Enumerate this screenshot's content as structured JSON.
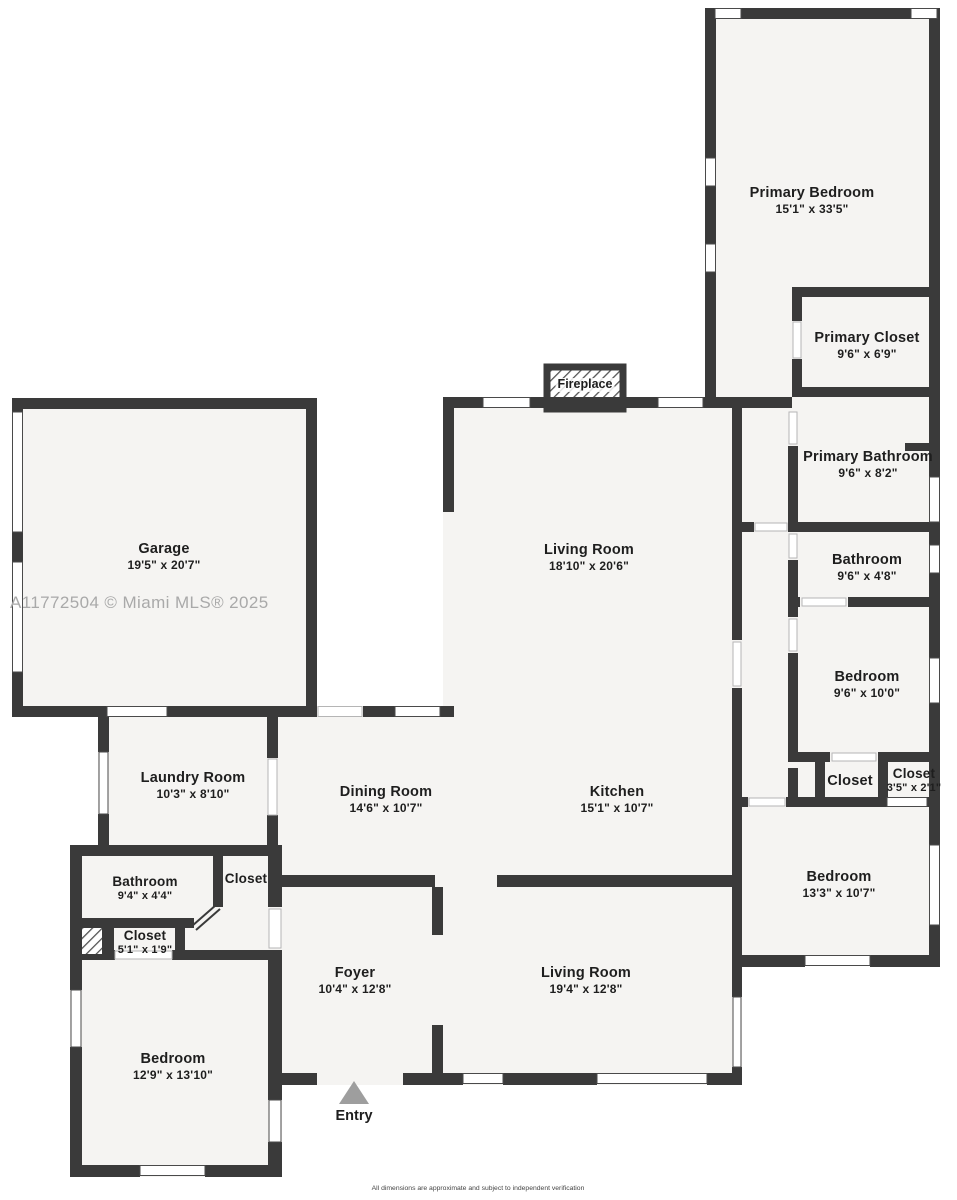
{
  "plan": {
    "watermark": "A11772504 © Miami MLS® 2025",
    "disclaimer": "All dimensions are approximate and subject to independent verification",
    "fireplace_label": "Fireplace",
    "entry_label": "Entry",
    "colors": {
      "wall": "#3a3a3a",
      "floor": "#f5f4f2",
      "watermark": "#a9a9a9",
      "entry_arrow": "#9e9e9e"
    },
    "rooms": [
      {
        "name": "Garage",
        "dims": "19'5\" x 20'7\""
      },
      {
        "name": "Laundry Room",
        "dims": "10'3\" x 8'10\""
      },
      {
        "name": "Dining Room",
        "dims": "14'6\" x 10'7\""
      },
      {
        "name": "Kitchen",
        "dims": "15'1\" x 10'7\""
      },
      {
        "name": "Living Room",
        "dims": "18'10\" x 20'6\""
      },
      {
        "name": "Foyer",
        "dims": "10'4\" x 12'8\""
      },
      {
        "name": "Living Room",
        "dims": "19'4\" x 12'8\""
      },
      {
        "name": "Bedroom",
        "dims": "12'9\" x 13'10\""
      },
      {
        "name": "Bathroom",
        "dims": "9'4\" x 4'4\""
      },
      {
        "name": "Closet",
        "dims": ""
      },
      {
        "name": "Closet",
        "dims": "5'1\" x 1'9\""
      },
      {
        "name": "Primary Bedroom",
        "dims": "15'1\" x 33'5\""
      },
      {
        "name": "Primary Closet",
        "dims": "9'6\" x 6'9\""
      },
      {
        "name": "Primary Bathroom",
        "dims": "9'6\" x 8'2\""
      },
      {
        "name": "Bathroom",
        "dims": "9'6\" x 4'8\""
      },
      {
        "name": "Bedroom",
        "dims": "9'6\" x 10'0\""
      },
      {
        "name": "Closet",
        "dims": ""
      },
      {
        "name": "Closet",
        "dims": "3'5\" x 2'1\""
      },
      {
        "name": "Bedroom",
        "dims": "13'3\" x 10'7\""
      }
    ]
  }
}
